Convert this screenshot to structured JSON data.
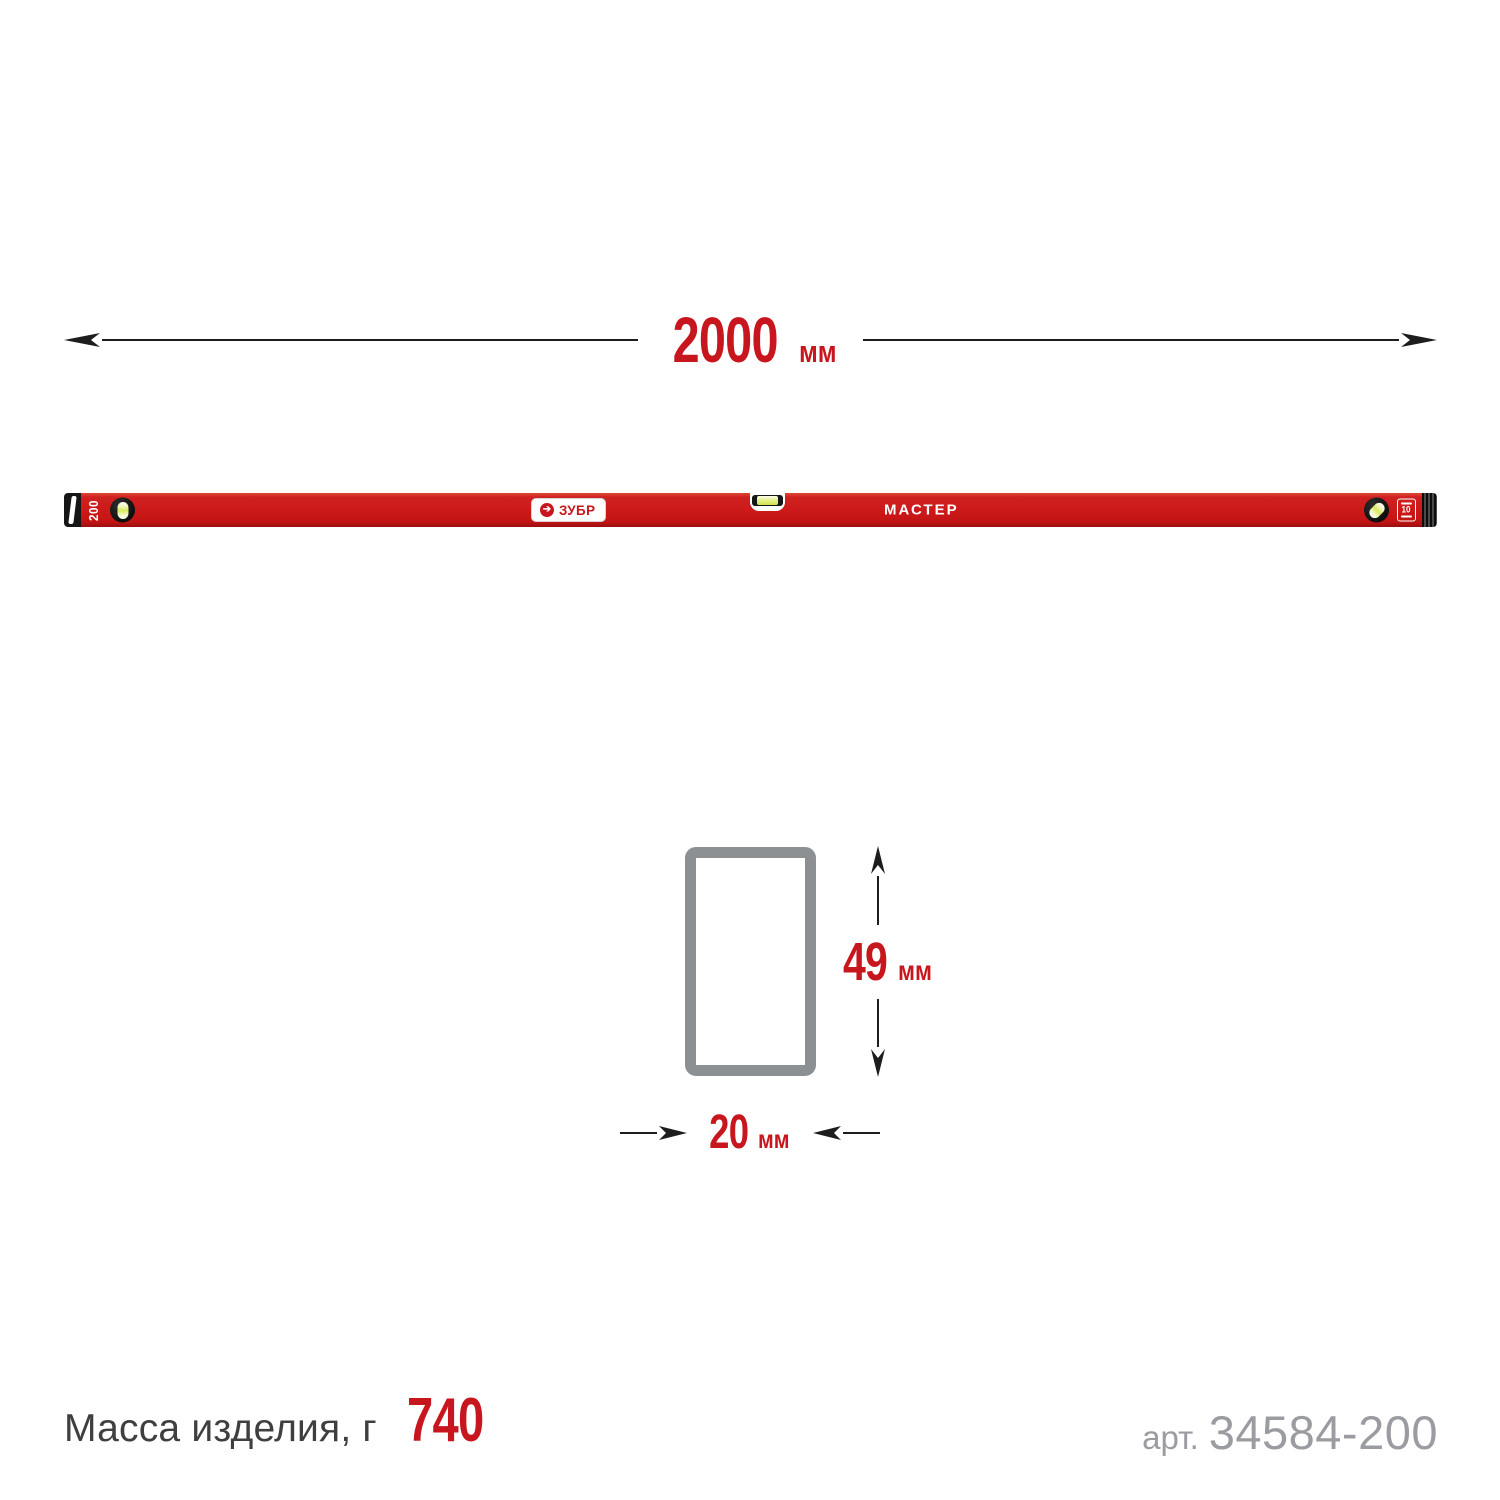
{
  "product": {
    "brand": "ЗУБР",
    "brand_mark": "➔",
    "series": "МАСТЕР",
    "size_marking": "200",
    "warranty_badge": "10"
  },
  "dimensions": {
    "length": {
      "value": "2000",
      "unit": "мм"
    },
    "profile_height": {
      "value": "49",
      "unit": "мм"
    },
    "profile_width": {
      "value": "20",
      "unit": "мм"
    }
  },
  "footer": {
    "mass_label": "Масса изделия, г",
    "mass_value": "740",
    "sku_label": "арт.",
    "sku_value": "34584-200"
  },
  "colors": {
    "accent_red": "#c8161e",
    "level_body_red": "#cb1818",
    "section_gray": "#8d9092",
    "text_dark": "#3f3f3f",
    "text_muted": "#9b9ca1",
    "line_black": "#1d1d1d"
  }
}
